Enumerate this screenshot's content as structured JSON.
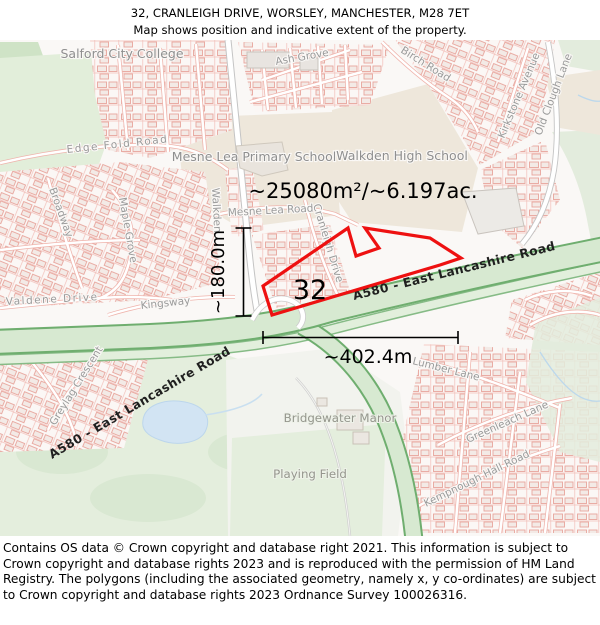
{
  "header": {
    "title": "32, CRANLEIGH DRIVE, WORSLEY, MANCHESTER, M28 7ET",
    "subtitle": "Map shows position and indicative extent of the property."
  },
  "annotations": {
    "area_label": "~25080m²/~6.197ac.",
    "width_label": "~402.4m",
    "height_label": "~180.0m",
    "plot_number": "32"
  },
  "map_labels": {
    "salford_city_college": "Salford City College",
    "edge_fold_road": "Edge Fold Road",
    "ash_grove": "Ash Grove",
    "birch_road": "Birch Road",
    "mesne_lea_primary_school": "Mesne Lea Primary School",
    "walkden_high_school": "Walkden High School",
    "kirkstone_avenue": "Kirkstone Avenue",
    "old_clough_lane": "Old Clough Lane",
    "walkden_road": "Walkden",
    "mesne_lea_road": "Mesne Lea Road",
    "cranleigh_drive": "Cranleigh Drive",
    "broadway": "Broadway",
    "maple_grove": "Maple Grove",
    "valdene_drive": "Valdene Drive",
    "kingsway": "Kingsway",
    "greylag_crescent": "Greylag Crescent",
    "a580_upper": "A580 - East Lancashire Road",
    "a580_lower": "A580 - East Lancashire Road",
    "bridgewater_manor": "Bridgewater Manor",
    "playing_field": "Playing Field",
    "lumber_lane": "Lumber Lane",
    "greenleach_lane": "Greenleach Lane",
    "kempnough_hall_road": "Kempnough Hall Road"
  },
  "colors": {
    "property_outline": "#ee1111",
    "road_green_fill": "#d7e9d1",
    "road_green_edge": "#6fae6f",
    "building_outline": "#e8a59d",
    "greenspace": "#e4eedd",
    "school_grounds": "#eee7db",
    "water": "#d2e4f3",
    "street_label": "#9a9a9a",
    "annotation_text": "#000000"
  },
  "footer": {
    "text": "Contains OS data © Crown copyright and database right 2021. This information is subject to Crown copyright and database rights 2023 and is reproduced with the permission of HM Land Registry. The polygons (including the associated geometry, namely x, y co-ordinates) are subject to Crown copyright and database rights 2023 Ordnance Survey 100026316."
  }
}
